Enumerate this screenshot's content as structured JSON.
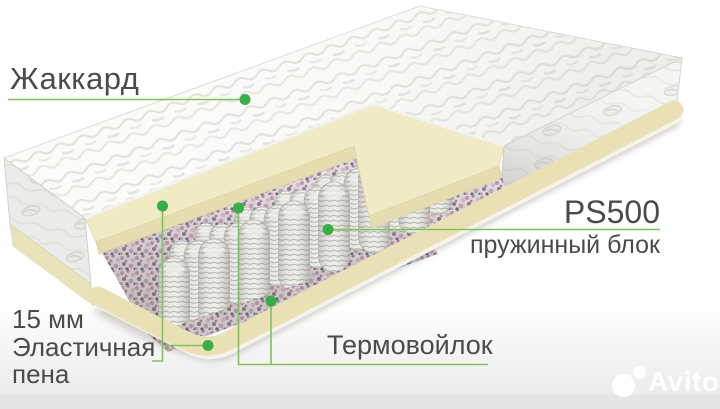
{
  "product": {
    "callouts": {
      "jacquard": "Жаккард",
      "spring_model": "PS500",
      "spring_block": "пружинный блок",
      "foam": "15 мм\nЭластичная\nпена",
      "thermofelt": "Термовойлок"
    }
  },
  "watermark": {
    "brand": "Avito"
  },
  "colors": {
    "annotation_line": "#7fc15c",
    "annotation_dot": "#37ae48",
    "label_text": "#4b4b4b",
    "foam_cream": "#f1ebc5",
    "base_cream": "#e9e1b5",
    "fabric_white": "#f7f7f5"
  }
}
